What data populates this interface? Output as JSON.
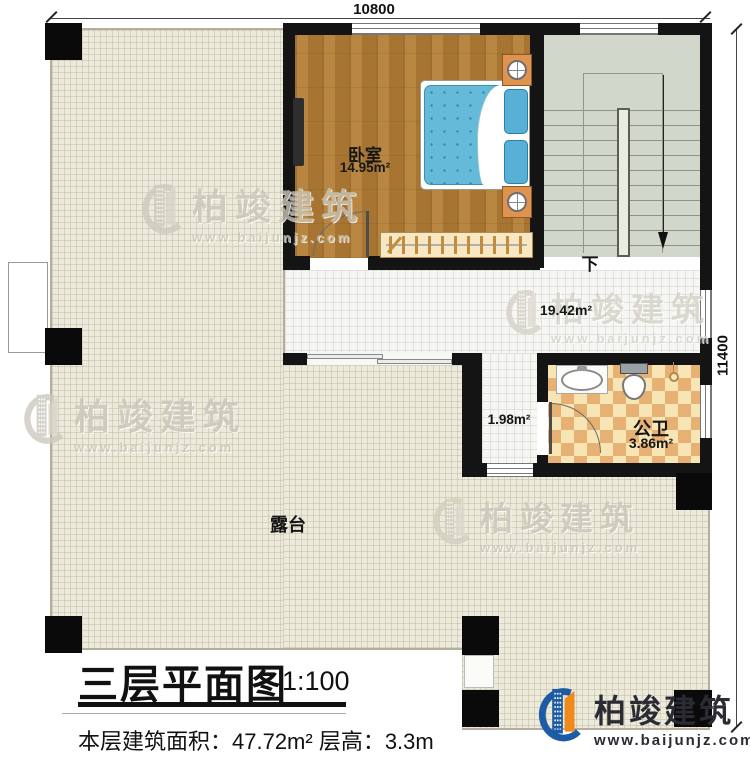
{
  "dimensions": {
    "top": "10800",
    "right": "11400"
  },
  "rooms": {
    "bedroom": {
      "name": "卧室",
      "area": "14.95m²"
    },
    "hallway": {
      "area": "19.42m²"
    },
    "corridor": {
      "area": "1.98m²"
    },
    "bathroom": {
      "name": "公卫",
      "area": "3.86m²"
    },
    "terrace": {
      "name": "露台"
    },
    "stairs": {
      "down_label": "下"
    }
  },
  "title_block": {
    "title": "三层平面图",
    "scale": "1:100",
    "info": "本层建筑面积：47.72m²  层高：3.3m"
  },
  "watermark": {
    "brand": "柏竣建筑",
    "url": "www.baijunjz.com"
  },
  "footer_logo": {
    "brand": "柏竣建筑",
    "url": "www.baijunjz.com"
  },
  "colors": {
    "wall": "#141414",
    "wood_floor": "#b07c35",
    "terrace_floor": "#eceadc",
    "tile_floor": "#f6f6f4",
    "stairs_floor": "#d2d7cb",
    "bath_checker_dark": "#e6b172",
    "bath_checker_light": "#f7e5b5",
    "bed_blue": "#65bada",
    "brand_blue": "#1d5ca5",
    "brand_orange": "#f08a1d"
  }
}
